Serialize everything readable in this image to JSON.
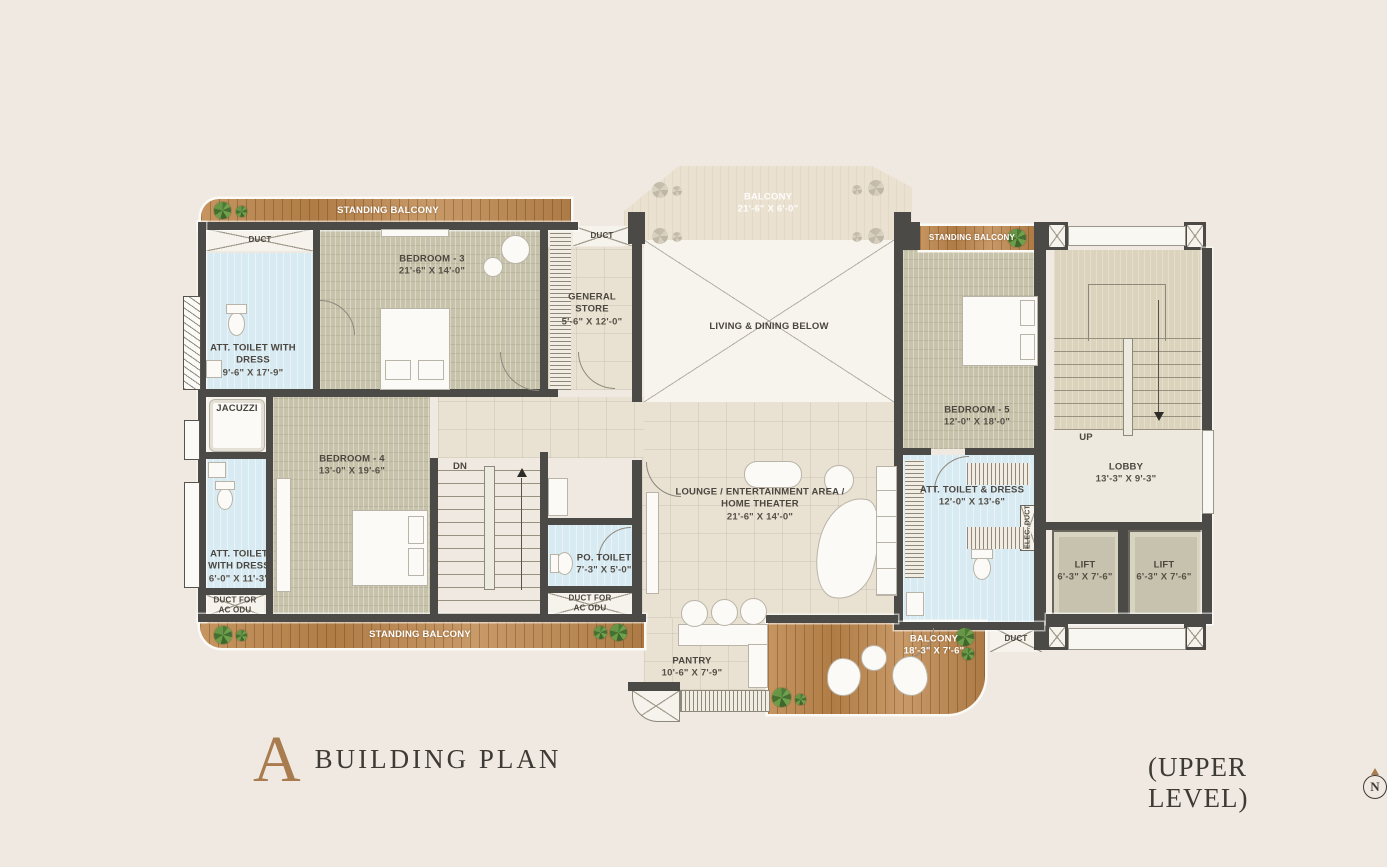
{
  "title": {
    "letter": "A",
    "name": "BUILDING PLAN",
    "level": "(UPPER LEVEL)",
    "compass": "N"
  },
  "colors": {
    "background": "#EFE9E1",
    "wall": "#4B4A46",
    "wood_deck": "#BE8C58",
    "carpet": "#C7C3AB",
    "wet_area_blue": "#D8EAF2",
    "floor_tile": "#E9E1D2",
    "stair_tan": "#DCD3BC",
    "accent_bronze": "#A87C4F"
  },
  "rooms": {
    "standing_balcony": {
      "name": "STANDING BALCONY"
    },
    "balcony_top": {
      "name": "BALCONY",
      "dim": "21'-6\" X 6'-0\""
    },
    "duct": {
      "name": "DUCT"
    },
    "duct_ac_odu_line1": {
      "name": "DUCT FOR"
    },
    "duct_ac_odu_line2": {
      "name": "AC ODU"
    },
    "elec_duct": {
      "name": "ELEC. DUCT"
    },
    "att_toilet_b3": {
      "name": "ATT. TOILET WITH DRESS",
      "dim": "9'-6\" X 17'-9\""
    },
    "bedroom3": {
      "name": "BEDROOM - 3",
      "dim": "21'-6\" X 14'-0\""
    },
    "jacuzzi": {
      "name": "JACUZZI"
    },
    "bedroom4": {
      "name": "BEDROOM - 4",
      "dim": "13'-0\" X 19'-6\""
    },
    "att_toilet_b4": {
      "name": "ATT. TOILET WITH DRESS",
      "dim": "6'-0\" X 11'-3\""
    },
    "general_store": {
      "name": "GENERAL STORE",
      "dim": "5'-6\" X 12'-0\""
    },
    "dn": {
      "name": "DN"
    },
    "up": {
      "name": "UP"
    },
    "po_toilet": {
      "name": "PO. TOILET",
      "dim": "7'-3\" X 5'-0\""
    },
    "living_dining": {
      "name": "LIVING & DINING BELOW"
    },
    "lounge": {
      "name": "LOUNGE / ENTERTAINMENT AREA /",
      "name2": "HOME THEATER",
      "dim": "21'-6\" X 14'-0\""
    },
    "pantry": {
      "name": "PANTRY",
      "dim": "10'-6\" X 7'-9\""
    },
    "balcony_bottom": {
      "name": "BALCONY",
      "dim": "18'-3\" X 7'-6\""
    },
    "bedroom5": {
      "name": "BEDROOM - 5",
      "dim": "12'-0\" X 18'-0\""
    },
    "att_toilet_b5": {
      "name": "ATT. TOILET & DRESS",
      "dim": "12'-0\" X 13'-6\""
    },
    "lobby": {
      "name": "LOBBY",
      "dim": "13'-3\" X 9'-3\""
    },
    "lift": {
      "name": "LIFT",
      "dim": "6'-3\" X 7'-6\""
    }
  }
}
